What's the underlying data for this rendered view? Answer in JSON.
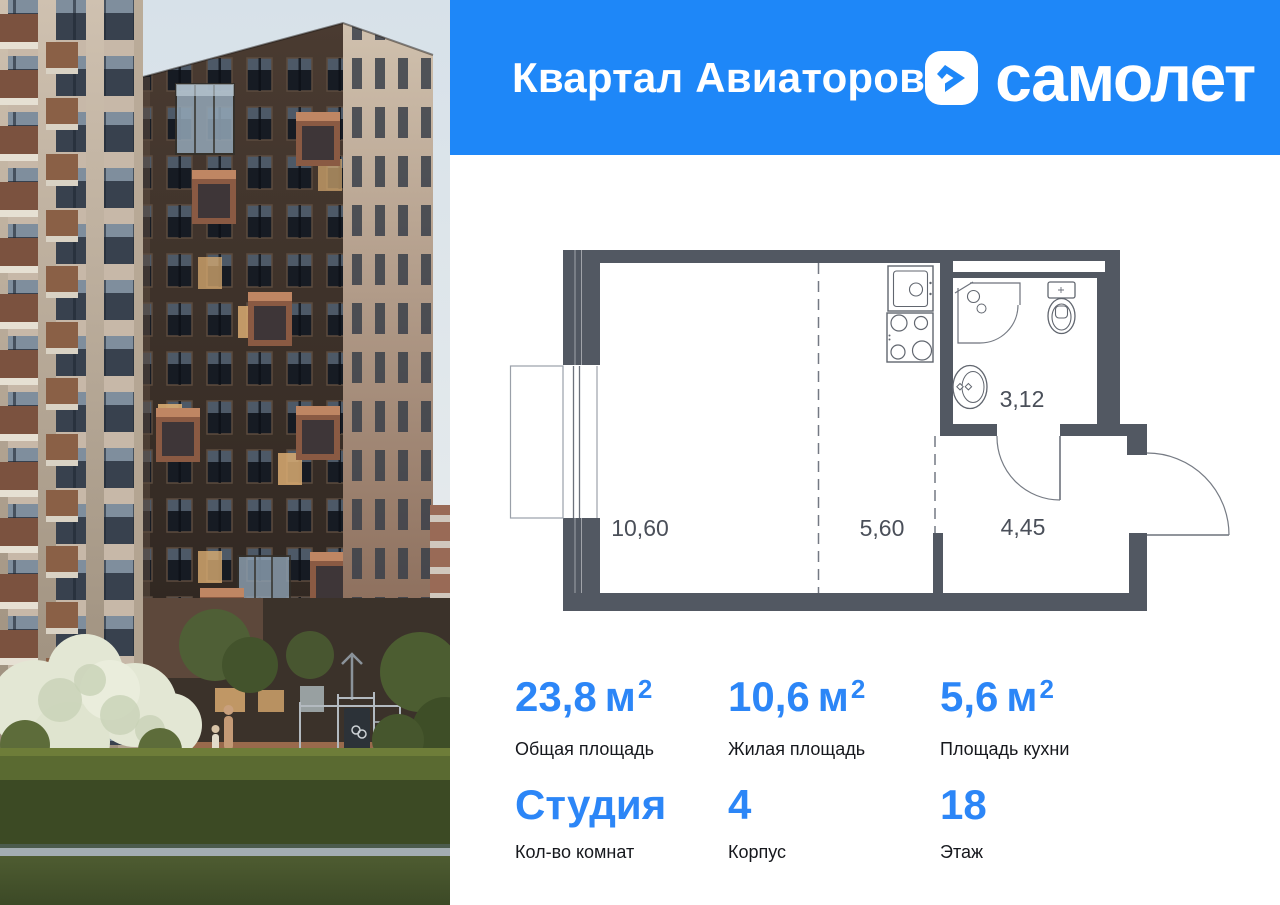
{
  "colors": {
    "accent": "#1E87F8",
    "value-blue": "#2C86F7",
    "wall": "#525862"
  },
  "header": {
    "project_title": "Квартал Авиаторов",
    "brand_name": "самолет",
    "logo_icon": "samolet-chevron-icon"
  },
  "photo": {
    "name": "residential-buildings-courtyard-photo"
  },
  "floorplan": {
    "rooms": [
      {
        "id": "living-room",
        "area": "10,60"
      },
      {
        "id": "kitchen",
        "area": "5,60"
      },
      {
        "id": "bathroom",
        "area": "3,12"
      },
      {
        "id": "hallway",
        "area": "4,45"
      }
    ]
  },
  "stats": [
    {
      "value": "23,8",
      "unit": "м",
      "sup": "2",
      "label": "Общая площадь"
    },
    {
      "value": "10,6",
      "unit": "м",
      "sup": "2",
      "label": "Жилая площадь"
    },
    {
      "value": "5,6",
      "unit": "м",
      "sup": "2",
      "label": "Площадь кухни"
    },
    {
      "value": "Студия",
      "unit": "",
      "sup": "",
      "label": "Кол-во комнат"
    },
    {
      "value": "4",
      "unit": "",
      "sup": "",
      "label": "Корпус"
    },
    {
      "value": "18",
      "unit": "",
      "sup": "",
      "label": "Этаж"
    }
  ]
}
